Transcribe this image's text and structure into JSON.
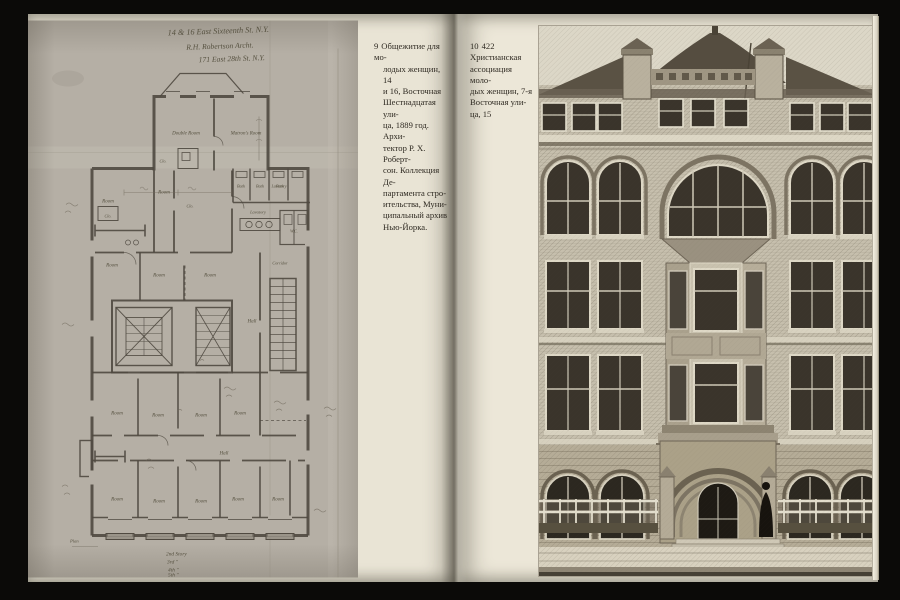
{
  "colors": {
    "background": "#0b0a08",
    "page_cream": "#ece7d8",
    "plan_paper": "#b5afa5",
    "plan_ink": "#4f4940",
    "photo_wall": "#c6bfad",
    "photo_window_dark": "#3a342b",
    "photo_roof_dark": "#554d40"
  },
  "plan": {
    "title_lines": [
      "14 & 16 East Sixteenth St. N.Y.",
      "R.H. Robertson Archt.",
      "171 East 28th St. N.Y."
    ],
    "labels": {
      "double_room": "Double Room",
      "matrons_room": "Matron's Room",
      "room": "Room",
      "hall": "Hall",
      "bath": "Bath",
      "lavatory": "Lavatory",
      "wc": "W.C.",
      "closet": "Clo.",
      "corridor": "Corridor",
      "plan_note": "Plan"
    },
    "floor_list": [
      "2nd Story",
      "3rd  \"",
      "4th  \"",
      "5th  \""
    ]
  },
  "captions": [
    {
      "number": "9",
      "lines": [
        "Общежитие для мо-",
        "лодых женщин, 14",
        "и 16, Восточная",
        "Шестнадцатая ули-",
        "ца, 1889 год. Архи-",
        "тектор Р. Х. Роберт-",
        "сон. Коллекция Де-",
        "партамента стро-",
        "ительства, Муни-",
        "ципальный архив",
        "Нью-Йорка."
      ]
    },
    {
      "number": "10",
      "lines": [
        "422 Христианская",
        "ассоциация моло-",
        "дых женщин, 7-я",
        "Восточная ули-",
        "ца, 15"
      ]
    }
  ]
}
